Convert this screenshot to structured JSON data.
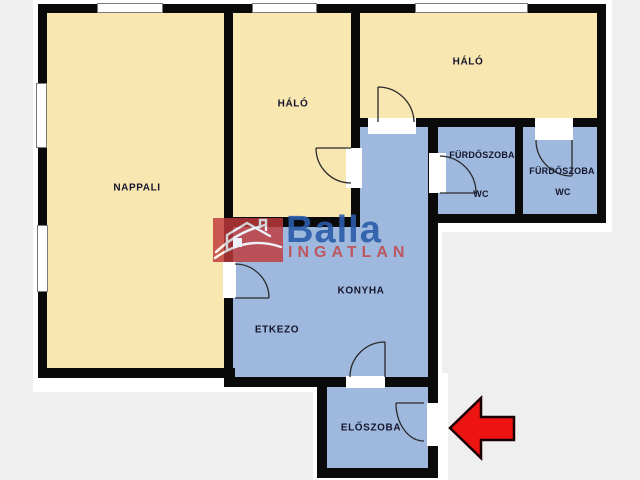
{
  "theme": {
    "bg": "#eeefee",
    "wall": "#0a0a0a",
    "room-warm": "#f8e7b0",
    "room-cool": "#9fb9de",
    "window-fill": "#ffffff",
    "label-color": "#15152c",
    "logo-red": "#c0393b",
    "logo-blue": "#2a5caa",
    "logo-text-red": "#c04f55",
    "arrow-red": "#ee1411"
  },
  "floorplan": {
    "rooms": [
      {
        "name": "nappali",
        "label": "NAPPALI"
      },
      {
        "name": "halo-middle",
        "label": "HÁLÓ"
      },
      {
        "name": "halo-right",
        "label": "HÁLÓ"
      },
      {
        "name": "furdoszoba-left",
        "label": "FÜRDŐSZOBA",
        "sublabel": "WC"
      },
      {
        "name": "furdoszoba-right",
        "label": "FÜRDŐSZOBA",
        "sublabel": "WC"
      },
      {
        "name": "konyha",
        "label": "KONYHA"
      },
      {
        "name": "etkezo",
        "label": "ETKEZO"
      },
      {
        "name": "eloszoba",
        "label": "ELŐSZOBA"
      }
    ]
  },
  "watermark": {
    "brand": "Balla",
    "tagline": "INGATLAN"
  }
}
